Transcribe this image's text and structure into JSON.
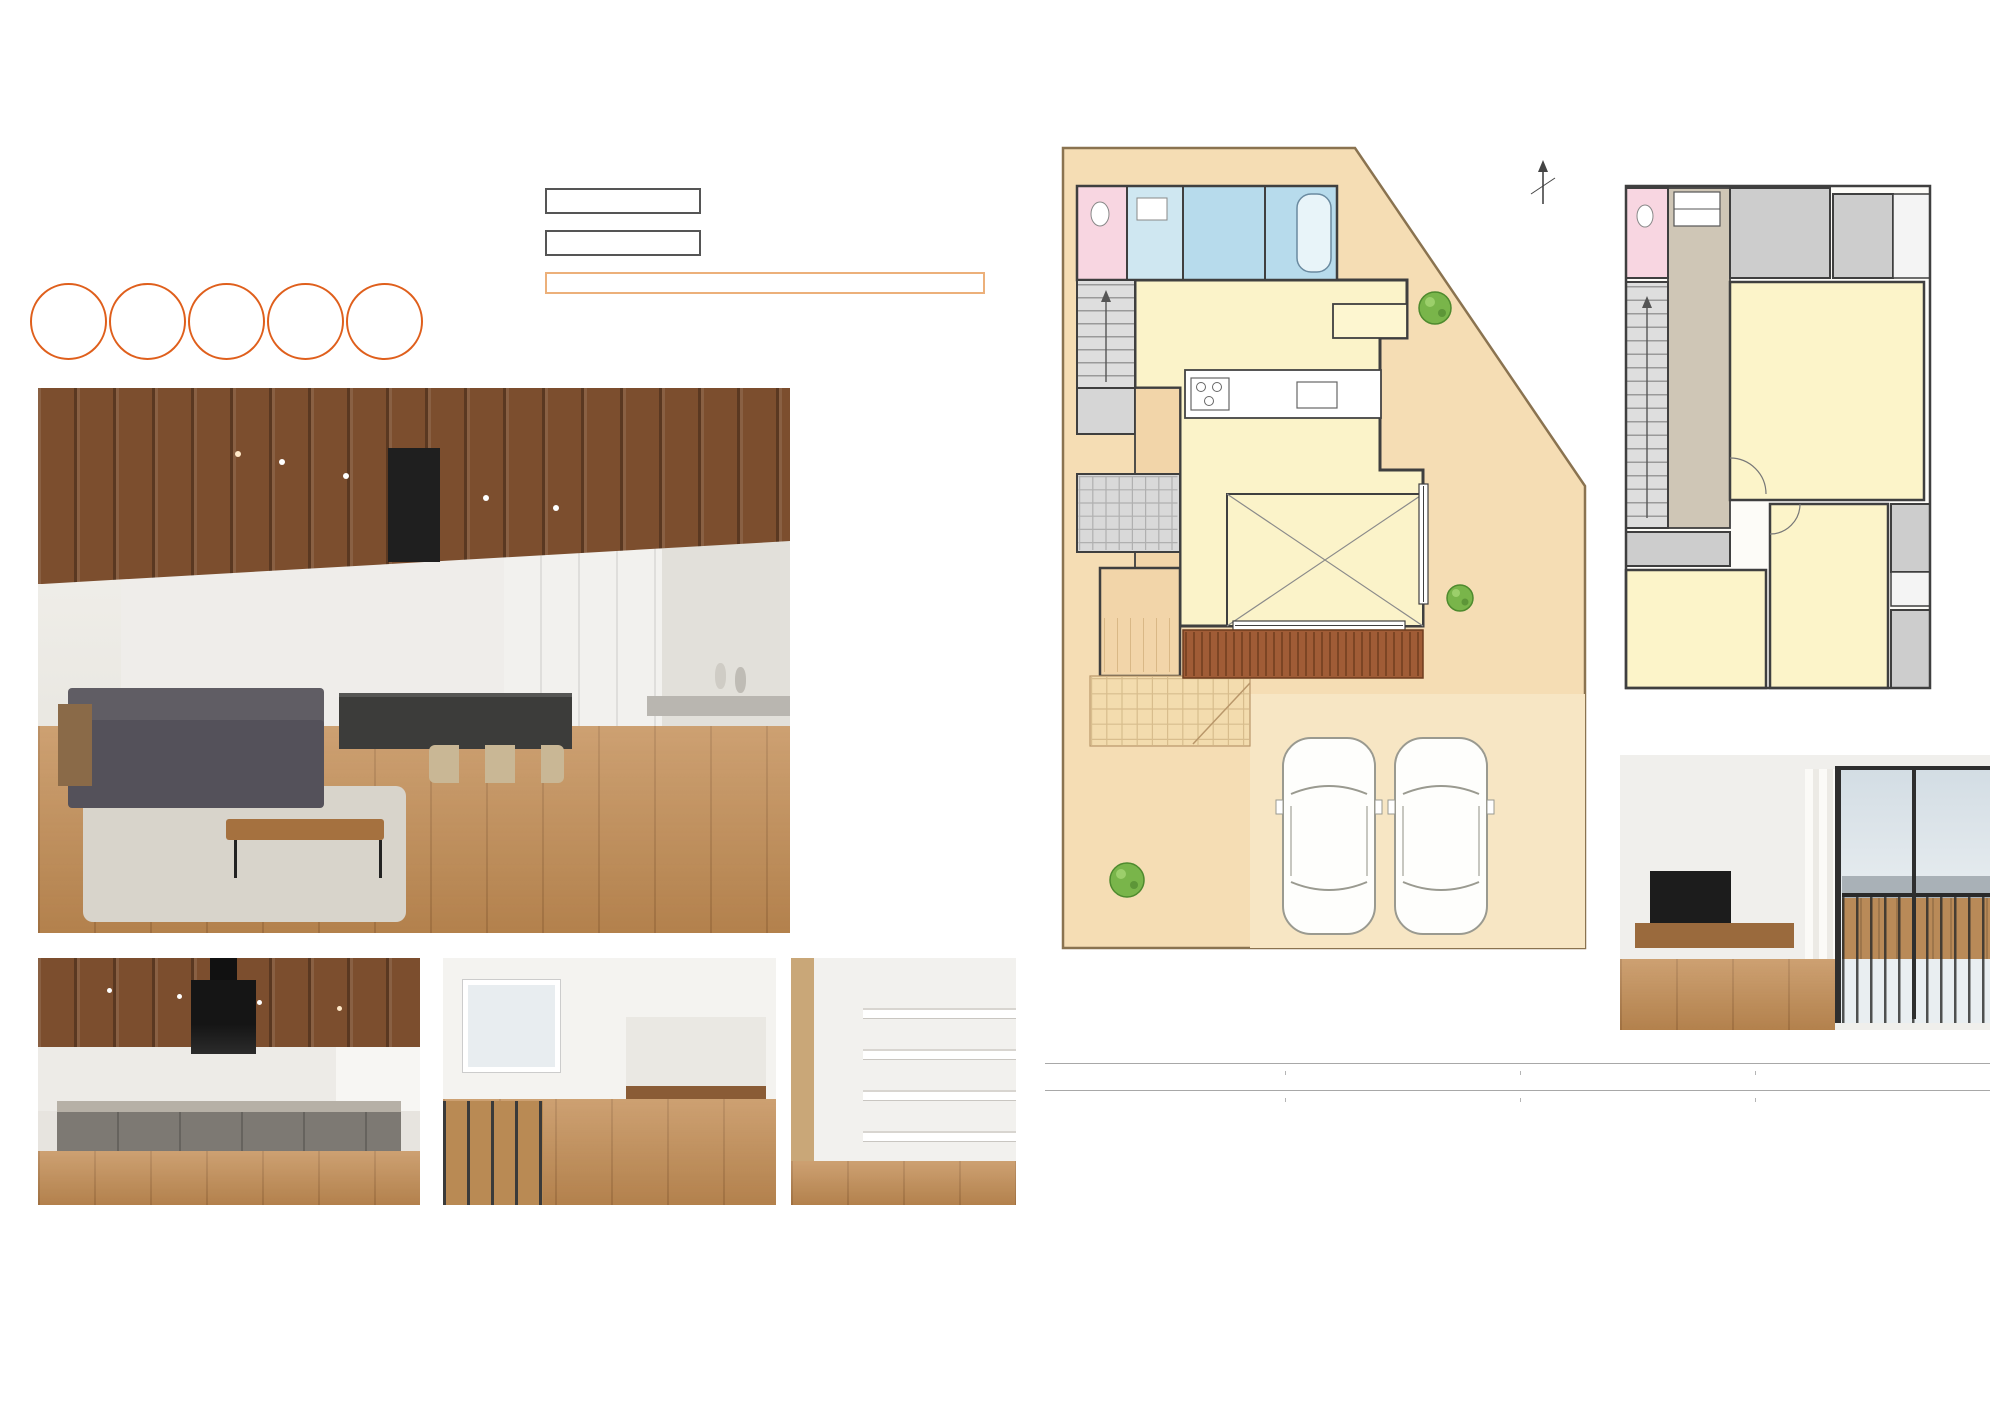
{
  "header": {
    "title": "レジリエンスパーク岡崎市百々町モデルハウス　［D区画］",
    "subtitle": "レジリエンスパーク岡崎市百々町モデルハウスでは、「地震に強い」「災害に備える」ミライのカタチをした住まいをご覧いただけます。お気軽にお越しください。"
  },
  "intro": {
    "catch_line1": "災害時にも、毎日の暮らしにも",
    "catch_line2": "「快適に住み続けられる家づくり」。",
    "badge_color": "#ee7330",
    "badges": [
      {
        "line1": "長期",
        "line2": "優良住宅",
        "line3": "標準"
      },
      {
        "line1": "耐震",
        "line2": "等級3",
        "line3": "取得"
      },
      {
        "line1": "耐風",
        "line2": "等級2",
        "line3": "取得"
      },
      {
        "line1": "省令",
        "line2": "準耐火",
        "line3": "標準"
      },
      {
        "line1": "GX",
        "line2": "仕様",
        "line3": ""
      }
    ]
  },
  "anshin": {
    "structure_label": "構造の安心",
    "structure_line1": "巨大地震に耐える強い家",
    "structure_line2": "（耐震構造）",
    "equipment_label": "設備の安心",
    "equipment_line1": "ライフライン遮断時も最低限の",
    "equipment_line2": "生活を確保（在宅避難）",
    "daily_text": "日常の暮らしも快適（創エネ・省エネ）",
    "colors": {
      "structure_text": "#72722f",
      "structure_border": "#4c4c44",
      "equipment_text": "#8abc4e",
      "equipment_border": "#a7ca7e",
      "daily_text": "#ef8c3d",
      "daily_border": "#ecb07a"
    }
  },
  "photos": {
    "main_caption": "サンクンリビングを備えた23.5帖の大空間LDK",
    "kitchen_caption": "スタイリッシュなアイランドキッチン",
    "freespace_caption": "2F フリースペース",
    "doma_caption": "土間収納",
    "balcony_caption": "リビングからつながるバルコニー"
  },
  "floorplan": {
    "f1": {
      "label": "1F",
      "north_label": "N",
      "rooms": {
        "toilet": "トイレ",
        "dressing": "脱衣室",
        "bath": "浴室",
        "pantry": "パントリー",
        "up": "UP",
        "dk": "DK(15.2帖)",
        "ldk": "LDK(23.5帖)",
        "storage": "物入",
        "doma": "土間収納",
        "entrance": "玄関",
        "sunken_line1": "サンクンリビング",
        "sunken_line2": "(8.3帖)"
      }
    },
    "f2": {
      "label": "2F",
      "rooms": {
        "toilet": "トイレ",
        "fcl_line1": "F.CL",
        "fcl_line2": "(2.7帖)",
        "cl_top": "CL",
        "hall": "ホール",
        "dn": "DN",
        "room67_line1": "洋室",
        "room67_line2": "(6.7帖)",
        "cl_bottom": "CL",
        "room54_line1": "洋室",
        "room54_line2": "(5.4帖)",
        "bedroom_line1": "寝室",
        "bedroom_line2": "(7.2帖)",
        "wcl_top": "W.CL",
        "wcl_bottom": "W.CL"
      }
    }
  },
  "areas": {
    "items": [
      {
        "bullet": "■",
        "text": "土地面積／160.13㎡(48.44坪)"
      },
      {
        "bullet": "■",
        "text": "延床面積／125.78㎡(38.11坪)"
      },
      {
        "bullet": "■",
        "text": "施工面積／130.66㎡(39.59坪)"
      },
      {
        "bullet": "",
        "text": ""
      },
      {
        "bullet": "■",
        "text": "1F床面積／ 63.89㎡(19.36坪)"
      },
      {
        "bullet": "■",
        "text": "2F床面積／ 61.89㎡(18.75坪)"
      }
    ]
  },
  "features": {
    "cells": [
      {
        "title": "テクノストラクチャーEX",
        "suffix": "",
        "desc1": "建築基準法(耐震等級)の1.75倍の強度を確保",
        "desc2": "(最高等級の耐震等級3は1.5倍)",
        "color": "#1c4f9c"
      },
      {
        "title": "60年長期保証",
        "suffix": "",
        "desc1": "安心して永く住んでいただける家づくり",
        "desc2": "",
        "color": "#2d7dd2"
      },
      {
        "title": "地震建替保証",
        "suffix": "",
        "desc1": "万一の地震にも家族の暮らしを守ります",
        "desc2": "",
        "color": "#1c4f9c"
      },
      {
        "title": "太陽光発電システム",
        "suffix": "(11kW)",
        "desc1": "毎日の電気をお得に&非常時も使えて安心",
        "desc2": "",
        "color": "#54b1e6"
      },
      {
        "title": "エコキュート",
        "suffix": "",
        "desc1": "ソーラーチャージ",
        "desc2": "太陽光発電の余剰電力を有効活用",
        "color": "#54b1e6"
      },
      {
        "title": "スマートエルラインライト",
        "suffix": "",
        "desc1": "停電時でも外部からの接続で給電対応",
        "desc2": "",
        "color": "#1c4f9c"
      },
      {
        "title": "貯水タンク",
        "suffix": "",
        "desc1": "断水時にも最大36L使用可能",
        "desc2": "",
        "color": "#3f97d8"
      },
      {
        "title": "雨水タンク",
        "suffix": "",
        "desc1": "非常時には生活用水としても活用可能",
        "desc2": "",
        "color": "#1c4f9c"
      }
    ]
  }
}
